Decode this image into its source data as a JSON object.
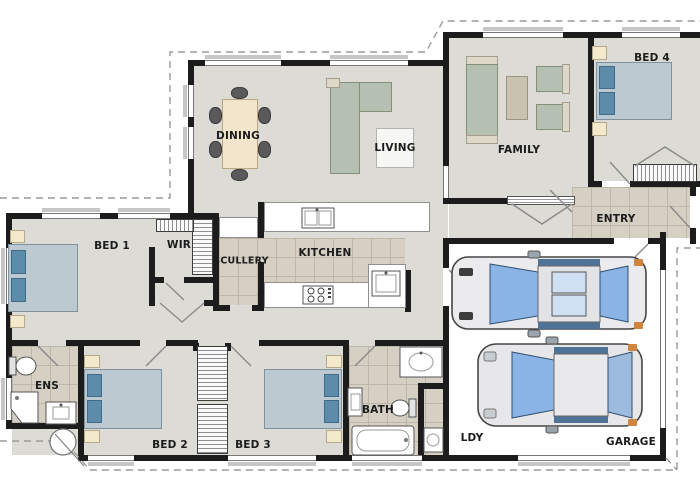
{
  "plan_type": "residential-floor-plan",
  "rooms": {
    "dining": {
      "label": "DINING"
    },
    "living": {
      "label": "LIVING"
    },
    "family": {
      "label": "FAMILY"
    },
    "bed4": {
      "label": "BED 4"
    },
    "entry": {
      "label": "ENTRY"
    },
    "bed1": {
      "label": "BED 1"
    },
    "wir": {
      "label": "WIR"
    },
    "scullery": {
      "label": "SCULLERY"
    },
    "kitchen": {
      "label": "KITCHEN"
    },
    "ens": {
      "label": "ENS"
    },
    "bed2": {
      "label": "BED 2"
    },
    "bed3": {
      "label": "BED 3"
    },
    "bath": {
      "label": "BATH"
    },
    "ldy": {
      "label": "LDY"
    },
    "garage": {
      "label": "GARAGE"
    }
  },
  "garage_contents": {
    "car_count": 2
  },
  "colors": {
    "wall": "#1c1c1c",
    "floor_grey": "#dcdbd6",
    "tile_beige": "#d5cfc4",
    "bed_blue": "#bcc9d1",
    "pillow_blue": "#5d8cab",
    "sofa_green": "#b6c0b2",
    "table_cream": "#f3e5cc",
    "car_glass_blue": "#8ab3e6",
    "car_marker_orange": "#cf8440",
    "eave_dash_grey": "#9b9b9b"
  }
}
